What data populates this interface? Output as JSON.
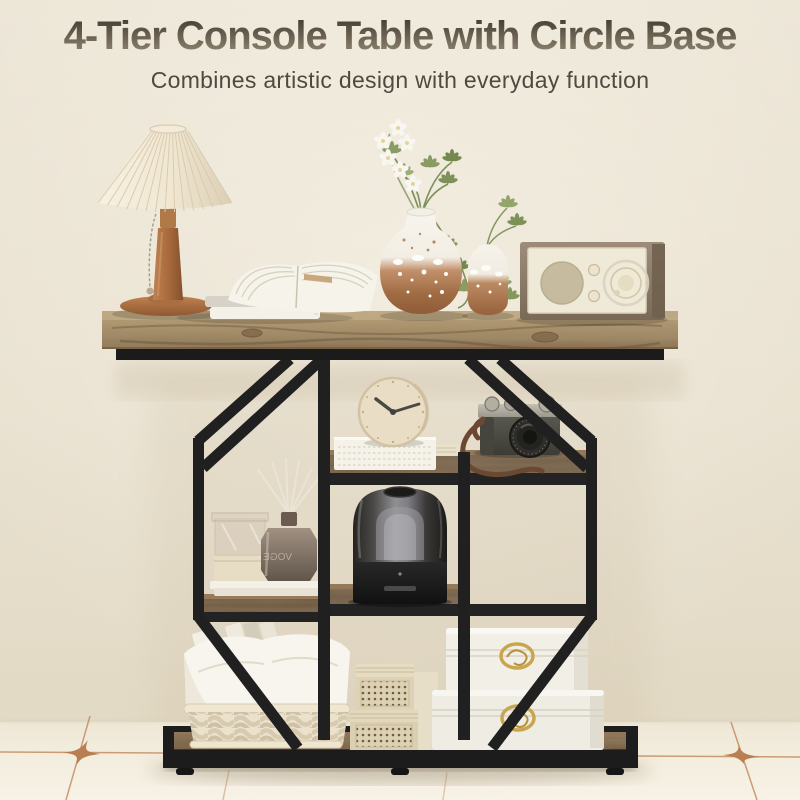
{
  "header": {
    "title": "4-Tier Console Table with Circle Base",
    "subtitle": "Combines artistic design with everyday function"
  },
  "scene": {
    "diffuser_label": "VOGE",
    "colors": {
      "wall": "#ebe4d4",
      "floor": "#f2ecdf",
      "tile_accent": "#b97f52",
      "tabletop_wood": "#a5906c",
      "metal_frame": "#202021",
      "lamp_wood": "#b5784a",
      "vase_terracotta": "#a9714a",
      "gold_clasp": "#c9a64e"
    },
    "objects": [
      "pleated-table-lamp",
      "stacked-books-with-open-book",
      "splatter-glaze-vase-with-orchids",
      "bud-vase-with-greenery",
      "vintage-radio",
      "desk-clock",
      "fabric-covered-book",
      "vintage-camera",
      "glass-display-box",
      "reed-diffuser",
      "smoked-glass-speaker",
      "woven-storage-basket",
      "perforated-gift-boxes",
      "white-jewelry-chests"
    ]
  }
}
